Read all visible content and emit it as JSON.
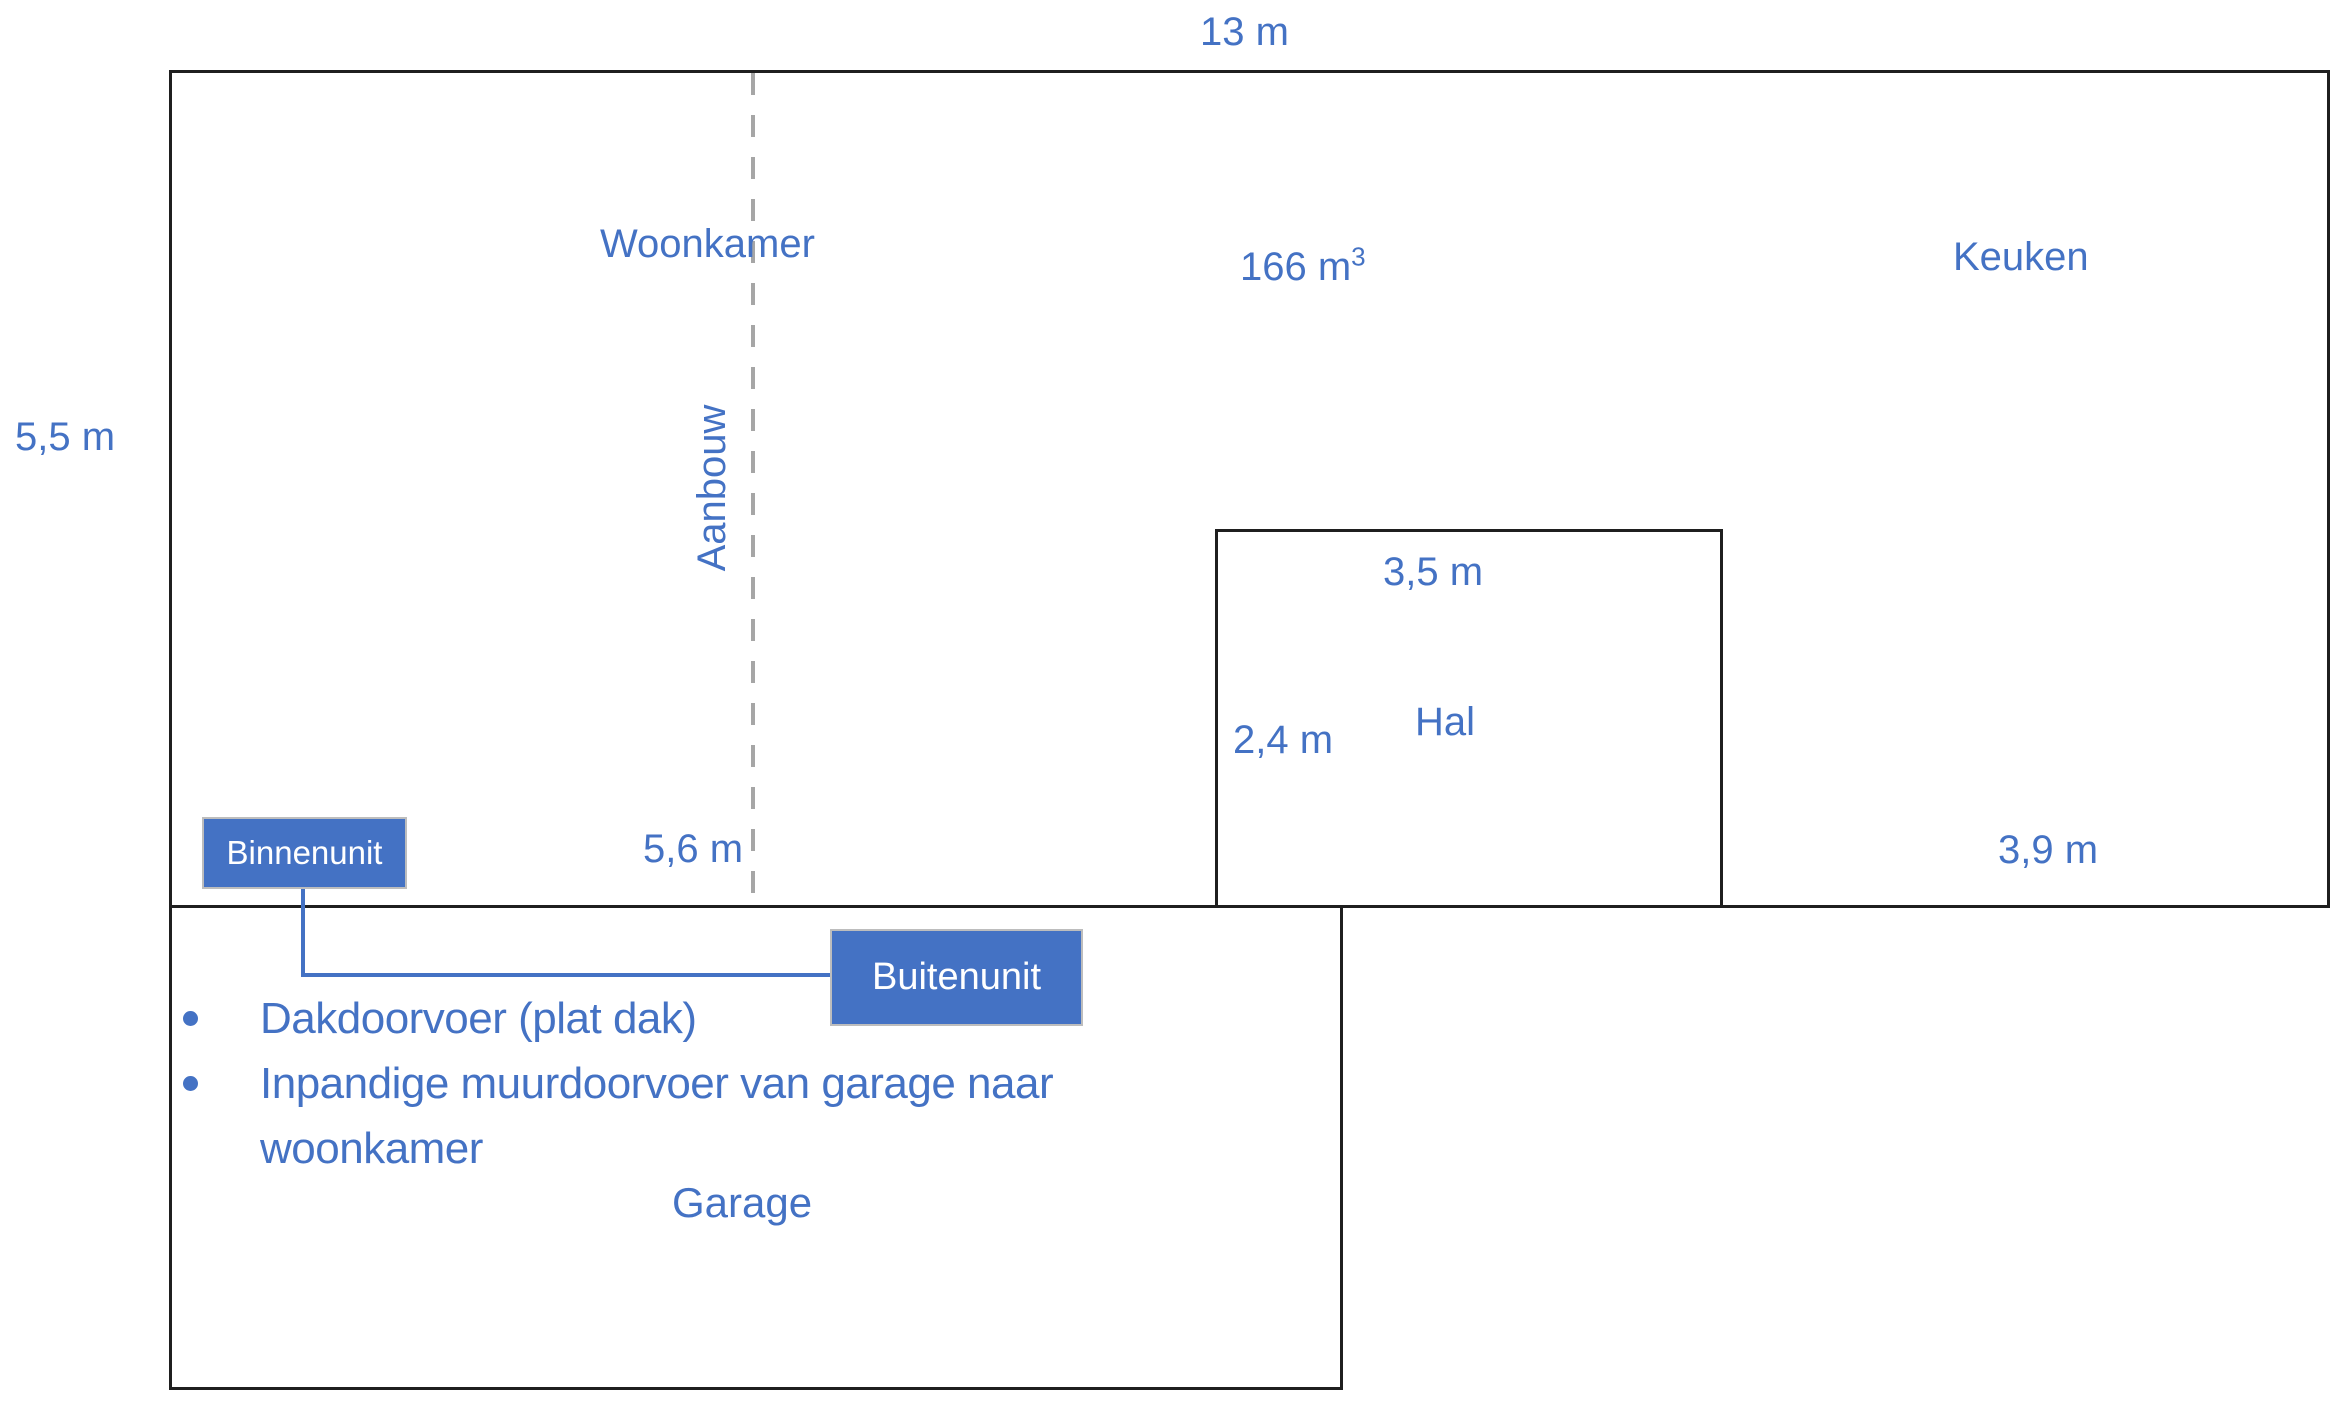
{
  "diagram": {
    "type": "floor-plan-sketch",
    "colors": {
      "accent_blue": "#4472C4",
      "outline_black": "#1f1f1f",
      "dashed_gray": "#A6A6A6",
      "unit_box_fill": "#4472C4",
      "unit_box_text": "#FFFFFF"
    },
    "rooms": {
      "woonkamer": {
        "label": "Woonkamer",
        "width_label": "13 m",
        "height_label": "5,5 m",
        "volume_value": "166 m",
        "volume_exponent": "3"
      },
      "aanbouw": {
        "label": "Aanbouw",
        "width_label": "5,6 m"
      },
      "keuken": {
        "label": "Keuken",
        "width_label": "3,9 m"
      },
      "hal": {
        "label": "Hal",
        "width_label": "3,5 m",
        "height_label": "2,4 m"
      },
      "garage": {
        "label": "Garage"
      }
    },
    "units": {
      "indoor_label": "Binnenunit",
      "outdoor_label": "Buitenunit"
    },
    "notes": {
      "items": [
        {
          "lines": [
            "Dakdoorvoer (plat dak)",
            ""
          ]
        },
        {
          "lines": [
            "Inpandige muurdoorvoer van garage naar",
            "woonkamer"
          ]
        }
      ]
    }
  }
}
